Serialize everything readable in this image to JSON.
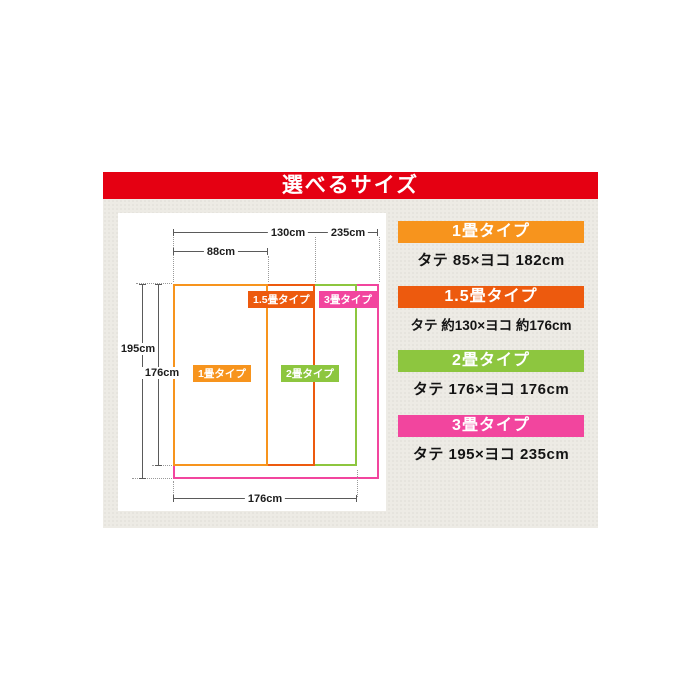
{
  "header": {
    "title": "選べるサイズ",
    "bg_color": "#e50012"
  },
  "colors": {
    "orange": "#f7941d",
    "dark_orange": "#ed5a0e",
    "green": "#8dc63f",
    "pink": "#f2459e"
  },
  "diagram": {
    "dim_labels": {
      "top_130": "130cm",
      "top_235": "235cm",
      "top_88": "88cm",
      "left_195": "195cm",
      "left_176": "176cm",
      "bottom_176": "176cm"
    },
    "badges": {
      "one": "1畳タイプ",
      "one_half": "1.5畳タイプ",
      "two": "2畳タイプ",
      "three": "3畳タイプ"
    }
  },
  "size_list": [
    {
      "label": "1畳タイプ",
      "spec": "タテ 85×ヨコ 182cm",
      "color": "#f7941d"
    },
    {
      "label": "1.5畳タイプ",
      "spec": "タテ 約130×ヨコ 約176cm",
      "color": "#ed5a0e"
    },
    {
      "label": "2畳タイプ",
      "spec": "タテ 176×ヨコ 176cm",
      "color": "#8dc63f"
    },
    {
      "label": "3畳タイプ",
      "spec": "タテ 195×ヨコ 235cm",
      "color": "#f2459e"
    }
  ]
}
